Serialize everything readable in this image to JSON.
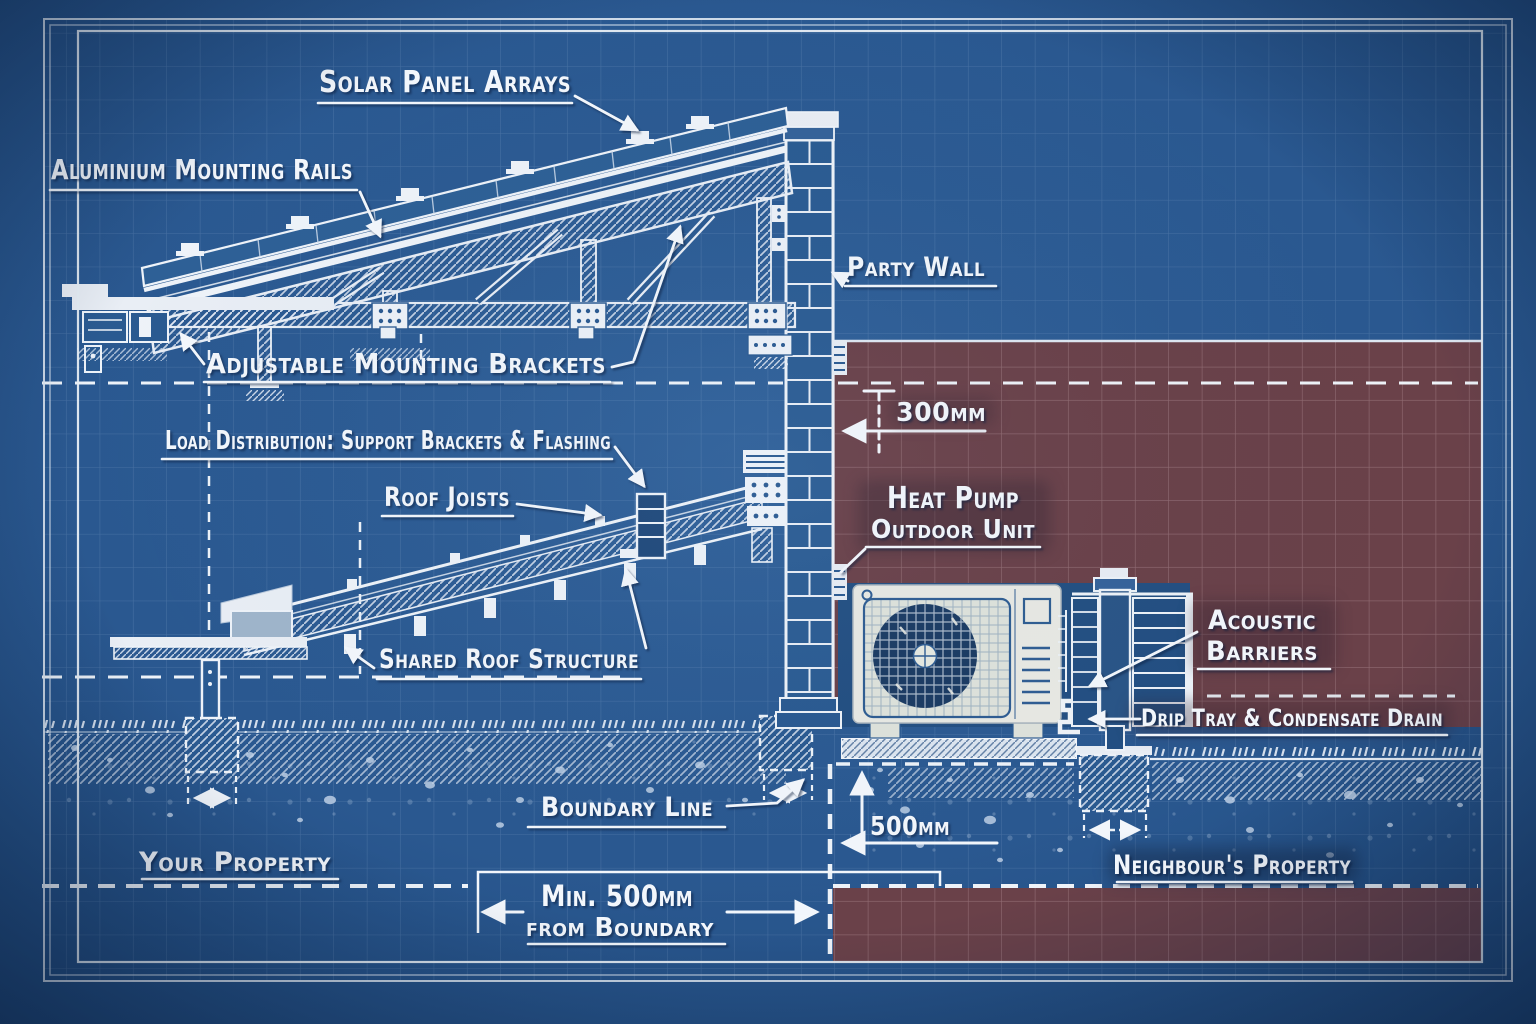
{
  "drawing_title": "Solar panel and heat pump party-wall boundary blueprint",
  "labels": {
    "solar_panel_arrays": "Solar Panel Arrays",
    "aluminium_mounting_rails": "Aluminium Mounting Rails",
    "adjustable_mounting_brackets": "Adjustable Mounting Brackets",
    "load_distribution": "Load Distribution: Support Brackets & Flashing",
    "roof_joists": "Roof Joists",
    "shared_roof_structure": "Shared Roof Structure",
    "party_wall": "Party Wall",
    "heat_pump_line1": "Heat Pump",
    "heat_pump_line2": "Outdoor Unit",
    "acoustic_line1": "Acoustic",
    "acoustic_line2": "Barriers",
    "drip_tray": "Drip Tray & Condensate Drain",
    "boundary_line": "Boundary Line",
    "your_property": "Your Property",
    "neighbours_property": "Neighbour's Property"
  },
  "dimensions": {
    "wall_offset": "300mm",
    "ground_offset": "500mm",
    "boundary_clearance_line1": "Min. 500mm",
    "boundary_clearance_line2": "from Boundary"
  },
  "colors": {
    "background_blue": "#2b5a91",
    "line_white": "#eef3f9",
    "neighbour_zone_red": "#6a4149",
    "panel_blue": "#2e6096",
    "unit_case": "#e9eae4",
    "fan_navy": "#1b3b63"
  }
}
